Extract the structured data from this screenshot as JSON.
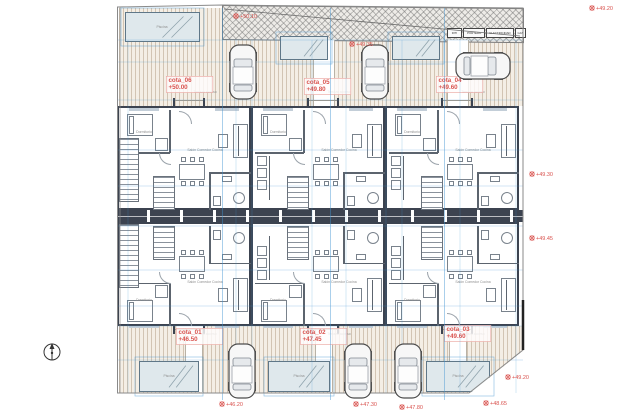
{
  "colors": {
    "wall": "#3c4350",
    "dimension": "#3f93d2",
    "annotation_red": "#d9534f",
    "deck_bg": "#f4eee5",
    "pool_fill": "#dfe8ec"
  },
  "units": {
    "top_row": [
      {
        "id": "cota_06",
        "level": "+50.00"
      },
      {
        "id": "cota_05",
        "level": "+49.80"
      },
      {
        "id": "cota_04",
        "level": "+49.60"
      }
    ],
    "bottom_row": [
      {
        "id": "cota_01",
        "level": "+46.50"
      },
      {
        "id": "cota_02",
        "level": "+47.45"
      },
      {
        "id": "cota_03",
        "level": "+49.60"
      }
    ]
  },
  "room_labels": {
    "bedroom": "Dormitorio",
    "living": "Salón Comedor Cocina",
    "bath": "Baño",
    "terrace": "Terraza acceso",
    "pool": "Piscina"
  },
  "meter_boxes": [
    "RITI",
    "PORTERO",
    "ELECTRICIDAD",
    "GAS"
  ],
  "annotations": {
    "level_markers": [
      {
        "x": 592,
        "y": 8,
        "label": "+49.20"
      },
      {
        "x": 236,
        "y": 16,
        "label": "+50.10"
      },
      {
        "x": 352,
        "y": 44,
        "label": "+49.35"
      },
      {
        "x": 532,
        "y": 174,
        "label": "+49.30"
      },
      {
        "x": 532,
        "y": 238,
        "label": "+49.45"
      },
      {
        "x": 222,
        "y": 404,
        "label": "+46.20"
      },
      {
        "x": 356,
        "y": 404,
        "label": "+47.30"
      },
      {
        "x": 402,
        "y": 407,
        "label": "+47.80"
      },
      {
        "x": 486,
        "y": 403,
        "label": "+48.65"
      },
      {
        "x": 508,
        "y": 377,
        "label": "+49.20"
      }
    ]
  }
}
